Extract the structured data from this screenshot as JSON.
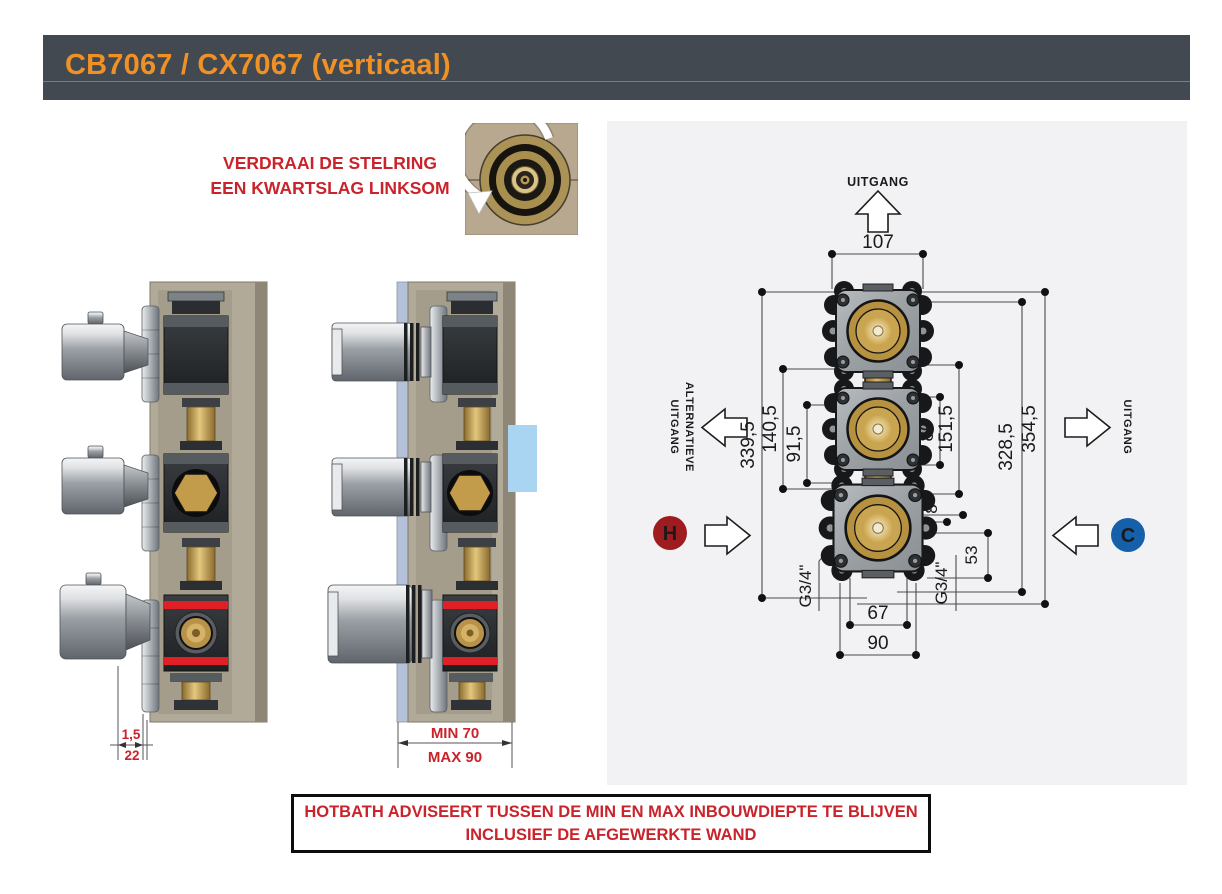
{
  "header": {
    "title": "CB7067 / CX7067 (verticaal)",
    "bar_color": "#424950",
    "accent_color": "#f09125"
  },
  "instruction": {
    "line1": "VERDRAAI DE STELRING",
    "line2": "EEN KWARTSLAG LINKSOM"
  },
  "warning": {
    "line1": "HOTBATH ADVISEERT TUSSEN DE MIN EN MAX INBOUWDIEPTE TE BLIJVEN",
    "line2": "INCLUSIEF DE AFGEWERKTE WAND"
  },
  "side_view_left": {
    "dims": {
      "plate_gap": "1,5",
      "depth": "22"
    }
  },
  "side_view_installed": {
    "dims": {
      "min_depth": "MIN 70",
      "max_depth": "MAX 90"
    }
  },
  "front_view": {
    "labels": {
      "outlet_top": "UITGANG",
      "outlet_alt_line1": "ALTERNATIEVE",
      "outlet_alt_line2": "UITGANG",
      "outlet_right": "UITGANG",
      "hot": "H",
      "cold": "C"
    },
    "dims": {
      "width_top": "107",
      "left_outer": "339,5",
      "left_mid": "140,5",
      "left_inner": "91,5",
      "right_inner": "80",
      "right_mid": "151,5",
      "right_outer": "328,5",
      "right_outermost": "354,5",
      "offset_small": "8",
      "offset_lower": "53",
      "bottom_inner": "67",
      "bottom_outer": "90",
      "thread_left": "G3/4\"",
      "thread_right": "G3/4\""
    },
    "colors": {
      "hot": "#9e1b20",
      "cold": "#1560a8"
    }
  }
}
